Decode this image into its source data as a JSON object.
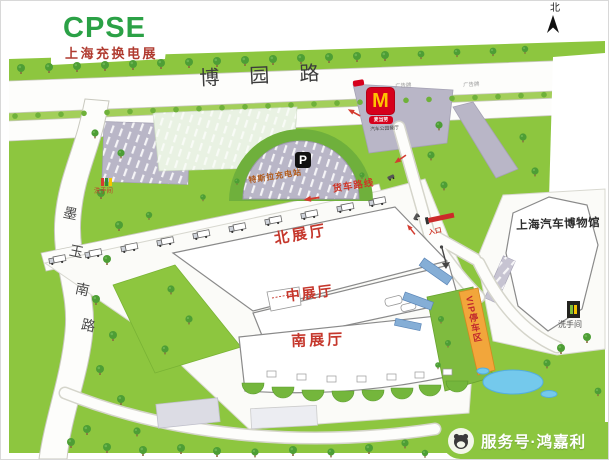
{
  "logo": {
    "title": "CPSE",
    "subtitle": "上海充换电展"
  },
  "compass": {
    "north": "北"
  },
  "roads": {
    "top": "博园路",
    "left_chars": [
      "墨",
      "玉",
      "南",
      "路"
    ]
  },
  "halls": {
    "north": "北展厅",
    "middle": "中展厅",
    "south": "南展厅"
  },
  "museum": {
    "name": "上海汽车博物馆"
  },
  "facilities": {
    "parking_sign": "P",
    "tesla_station": "特斯拉充电站",
    "truck_route": "货车路线",
    "vip_parking": "VIP停车区",
    "entrance": "入口",
    "restroom_left": "洗手间",
    "restroom_right": "洗手间",
    "billboard_a": "广告牌",
    "billboard_b": "广告牌",
    "mcdonalds_m": "M",
    "mcdonalds_name": "麦当劳",
    "mcdonalds_sub": "汽车公园餐厅"
  },
  "watermark": {
    "account": "服务号·鸿嘉利"
  },
  "colors": {
    "grass": "#8dc63f",
    "tree": "#4d9e35",
    "road": "#fdfdfb",
    "parking_gray": "#b9b6c7",
    "brand_green": "#2ba146",
    "brand_red": "#b03b30",
    "hall_label_red": "#c5372c",
    "mcdonalds_red": "#d6001c",
    "mcdonalds_yellow": "#ffc300",
    "vip_orange": "#f2a63b",
    "pond_blue": "#74c9ec",
    "watermark_green": "#8cc63f"
  }
}
